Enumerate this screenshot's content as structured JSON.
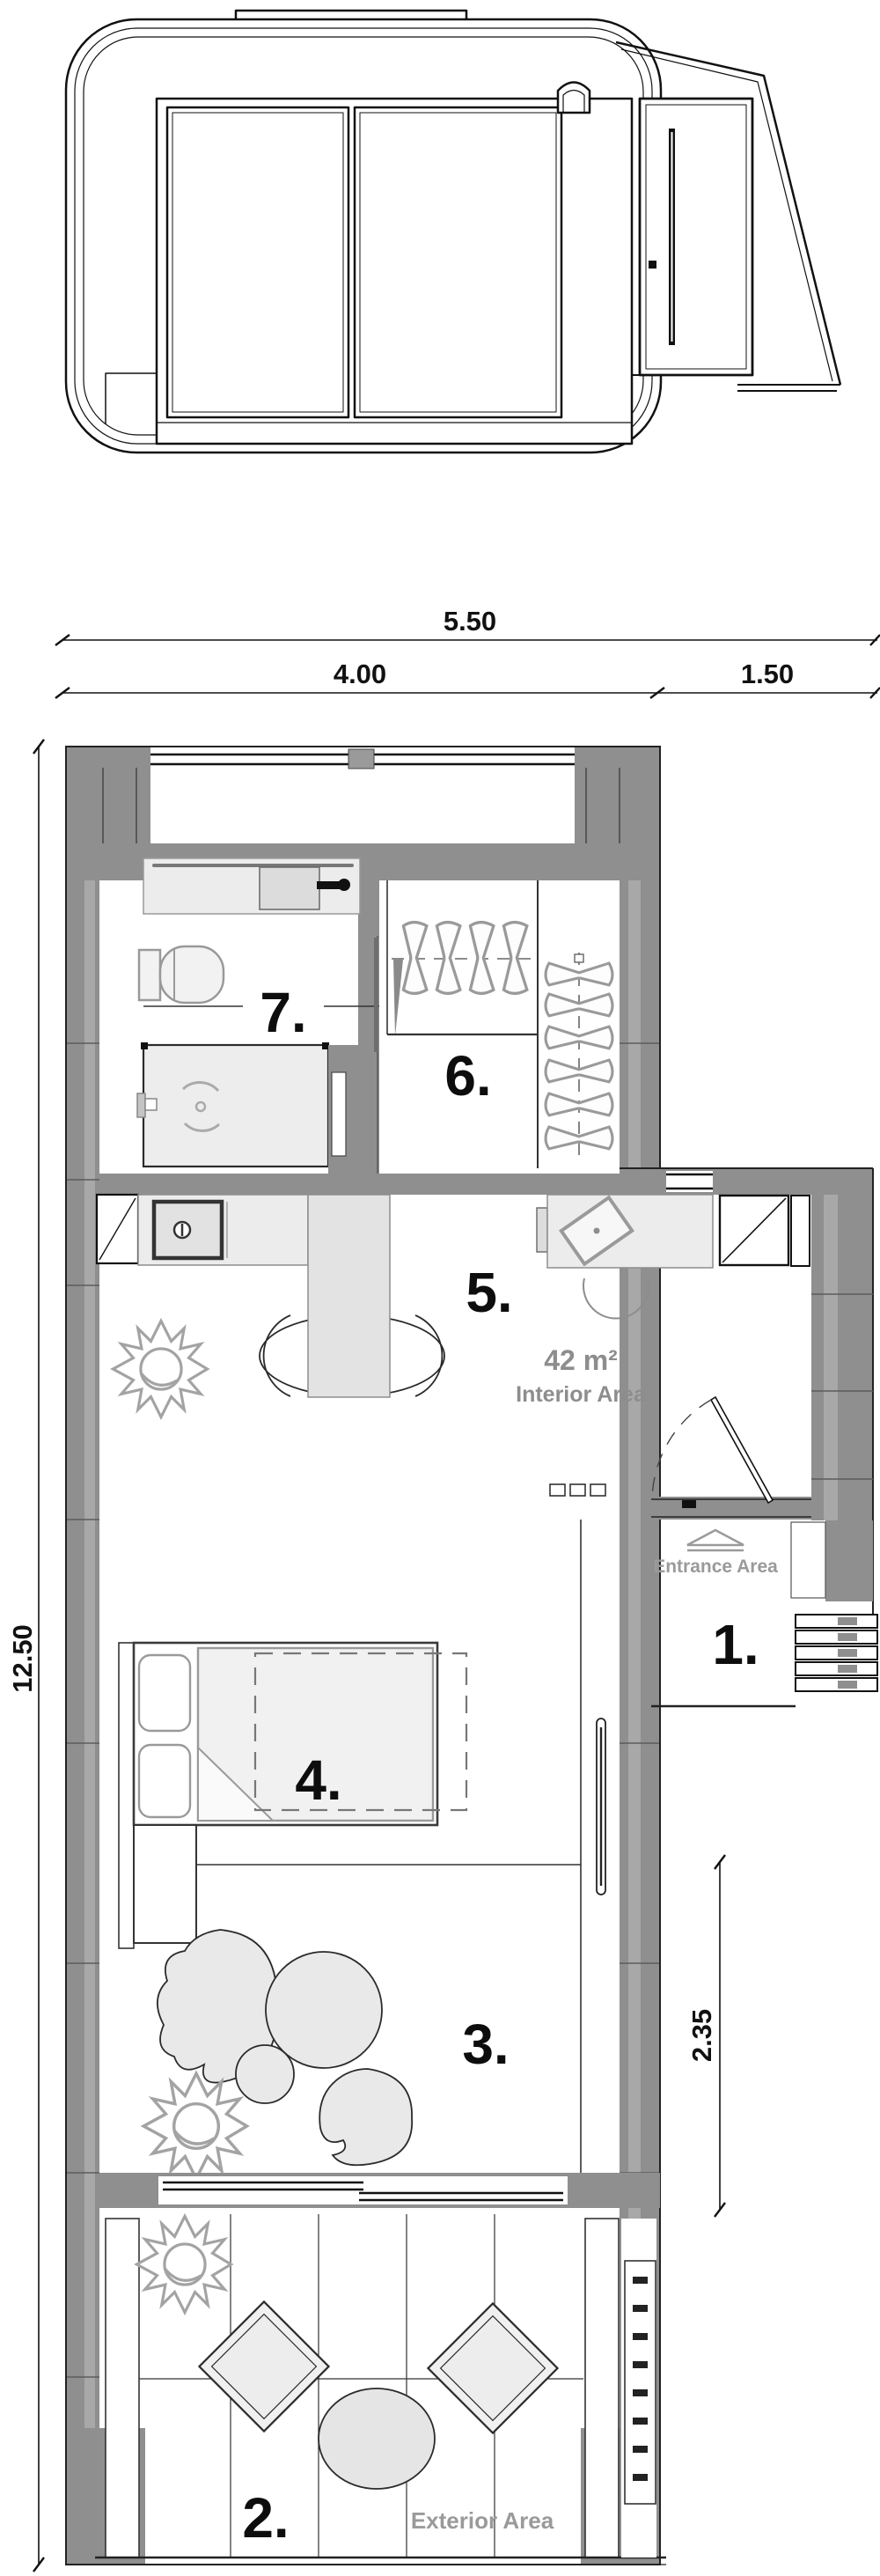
{
  "dimensions": {
    "total_width": "5.50",
    "main_module_width": "4.00",
    "annex_width": "1.50",
    "total_length": "12.50",
    "living_room_depth": "2.35"
  },
  "areas": {
    "interior_value": "42 m²",
    "interior_label": "Interior Area",
    "entrance_label": "Entrance Area",
    "exterior_label": "Exterior Area"
  },
  "rooms": {
    "r1": {
      "label": "1."
    },
    "r2": {
      "label": "2."
    },
    "r3": {
      "label": "3."
    },
    "r4": {
      "label": "4."
    },
    "r5": {
      "label": "5."
    },
    "r6": {
      "label": "6."
    },
    "r7": {
      "label": "7."
    }
  },
  "colors": {
    "wall": "#8f8f8f",
    "wall_light": "#a8a8a8",
    "furniture_fill": "#ececec",
    "line": "#1a1a1a",
    "muted_label": "#919191"
  }
}
